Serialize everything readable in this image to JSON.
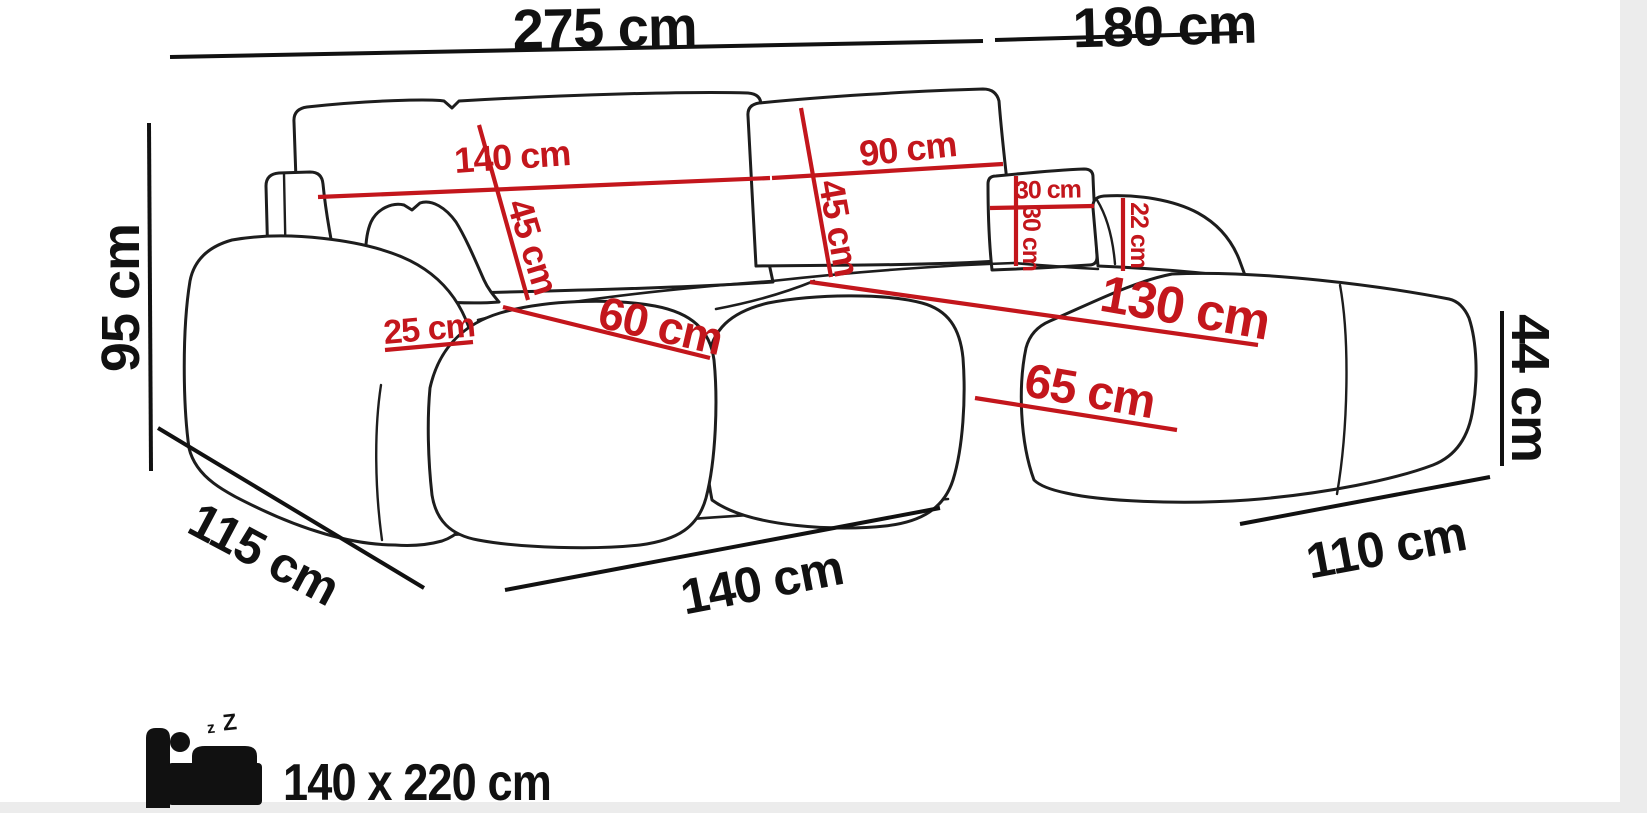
{
  "diagram": {
    "type": "corner-sofa-dimension-diagram",
    "colors": {
      "background": "#ffffff",
      "outline": "#1d1d1d",
      "dimension_black": "#111111",
      "dimension_red": "#c3161c",
      "edge_shadow": "#ececec"
    },
    "overall": {
      "back_width_left": "275 cm",
      "back_width_right": "180 cm",
      "total_height": "95 cm",
      "seat_height": "44 cm",
      "side_depth_left": "115 cm",
      "front_width": "140 cm",
      "side_depth_right": "110 cm"
    },
    "details": {
      "back_cushion_left_width": "140 cm",
      "back_cushion_left_height": "45 cm",
      "back_cushion_right_width": "90 cm",
      "back_cushion_right_height": "45 cm",
      "small_pillow_width": "30 cm",
      "small_pillow_height": "30 cm",
      "right_armrest_height": "22 cm",
      "chaise_seat_length": "130 cm",
      "chaise_seat_width": "65 cm",
      "seat_segment_width": "60 cm",
      "left_armrest_width": "25 cm"
    },
    "sleeping": {
      "icon": "sleeping-bed-icon",
      "zzz_small": "z",
      "zzz_large": "Z",
      "bed_size": "140 x 220 cm"
    }
  }
}
